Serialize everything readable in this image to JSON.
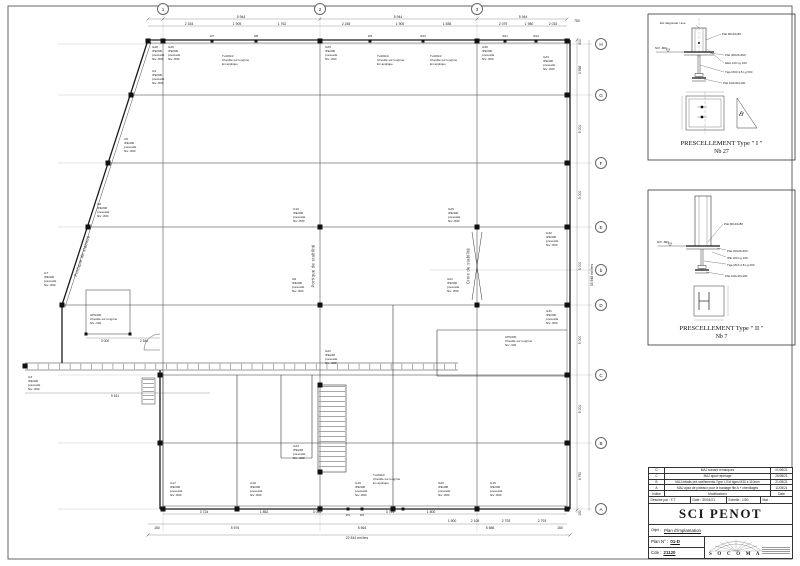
{
  "plan": {
    "bubbles": [
      {
        "t": "1",
        "x": 163,
        "y": 9
      },
      {
        "t": "2",
        "x": 320,
        "y": 9
      },
      {
        "t": "3",
        "x": 477,
        "y": 9
      },
      {
        "t": "H",
        "x": 601,
        "y": 44
      },
      {
        "t": "G",
        "x": 601,
        "y": 95
      },
      {
        "t": "F",
        "x": 601,
        "y": 163
      },
      {
        "t": "E",
        "x": 601,
        "y": 227
      },
      {
        "t": "b",
        "x": 601,
        "y": 270
      },
      {
        "t": "D",
        "x": 601,
        "y": 305
      },
      {
        "t": "C",
        "x": 601,
        "y": 375
      },
      {
        "t": "B",
        "x": 601,
        "y": 443
      },
      {
        "t": "A",
        "x": 601,
        "y": 509
      }
    ],
    "dims": [
      {
        "x": 241,
        "y": 17,
        "t": "5 944"
      },
      {
        "x": 398,
        "y": 17,
        "t": "5 944"
      },
      {
        "x": 523,
        "y": 17,
        "t": "5 944"
      },
      {
        "x": 189,
        "y": 24,
        "t": "2 334"
      },
      {
        "x": 237,
        "y": 24,
        "t": "1 905"
      },
      {
        "x": 282,
        "y": 24,
        "t": "1 762"
      },
      {
        "x": 346,
        "y": 24,
        "t": "2 248"
      },
      {
        "x": 400,
        "y": 24,
        "t": "1 905"
      },
      {
        "x": 447,
        "y": 24,
        "t": "1 836"
      },
      {
        "x": 503,
        "y": 24,
        "t": "2 079"
      },
      {
        "x": 529,
        "y": 24,
        "t": "1 980"
      },
      {
        "x": 553,
        "y": 24,
        "t": "2 015"
      },
      {
        "x": 577,
        "y": 21,
        "t": "750"
      },
      {
        "x": 580,
        "y": 42,
        "t": "500",
        "rot": -90
      },
      {
        "x": 580,
        "y": 70,
        "t": "3 598",
        "rot": -90
      },
      {
        "x": 580,
        "y": 129,
        "t": "5 000",
        "rot": -90
      },
      {
        "x": 580,
        "y": 195,
        "t": "5 000",
        "rot": -90
      },
      {
        "x": 580,
        "y": 266,
        "t": "5 000",
        "rot": -90
      },
      {
        "x": 580,
        "y": 340,
        "t": "5 000",
        "rot": -90
      },
      {
        "x": 580,
        "y": 409,
        "t": "5 000",
        "rot": -90
      },
      {
        "x": 580,
        "y": 476,
        "t": "4 750",
        "rot": -90
      },
      {
        "x": 580,
        "y": 513,
        "t": "150",
        "rot": -90
      },
      {
        "x": 591.5,
        "y": 275,
        "t": "33 948 ext fers",
        "rot": -90
      },
      {
        "x": 204,
        "y": 512,
        "t": "3 724"
      },
      {
        "x": 264,
        "y": 512,
        "t": "1 852"
      },
      {
        "x": 317,
        "y": 512,
        "t": "3 046"
      },
      {
        "x": 390,
        "y": 512,
        "t": "3 724"
      },
      {
        "x": 431,
        "y": 512,
        "t": "1 800"
      },
      {
        "x": 452,
        "y": 521,
        "t": "1 500"
      },
      {
        "x": 475,
        "y": 521,
        "t": "2 108"
      },
      {
        "x": 506,
        "y": 521,
        "t": "2 793"
      },
      {
        "x": 542,
        "y": 521,
        "t": "2 793"
      },
      {
        "x": 157,
        "y": 528,
        "t": "150"
      },
      {
        "x": 235,
        "y": 528,
        "t": "5 576"
      },
      {
        "x": 362,
        "y": 528,
        "t": "5 564"
      },
      {
        "x": 490,
        "y": 528,
        "t": "5 586"
      },
      {
        "x": 560,
        "y": 528,
        "t": "150"
      },
      {
        "x": 357,
        "y": 538,
        "t": "22 544 ext fers"
      },
      {
        "x": 115,
        "y": 396,
        "t": "9 611"
      },
      {
        "x": 105,
        "y": 341,
        "t": "3 000"
      },
      {
        "x": 144,
        "y": 341,
        "t": "2 540"
      }
    ],
    "col_labels": [
      {
        "x": 152,
        "y": 46,
        "t": "G28\nIPE300\nprescellé\nNiv -800"
      },
      {
        "x": 168,
        "y": 46,
        "t": "G26\nIPE300\nprescellé\nNiv -800"
      },
      {
        "x": 325,
        "y": 46,
        "t": "G25\nIPE300\nprescellé\nNiv -800"
      },
      {
        "x": 482,
        "y": 46,
        "t": "G30\nIPE300\nprescellé\nNiv -800"
      },
      {
        "x": 543,
        "y": 56,
        "t": "G34\nIPE300\nprescellé\nNiv -800"
      },
      {
        "x": 152,
        "y": 70,
        "t": "G4\nIPE300\nprescellé\nNiv -800"
      },
      {
        "x": 124,
        "y": 138,
        "t": "G5\nIPE300\nprescellé\nNiv -800"
      },
      {
        "x": 97,
        "y": 203,
        "t": "G6\nIPE300\nprescellé\nNiv -800"
      },
      {
        "x": 44,
        "y": 272,
        "t": "G7\nIPE300\nprescellé\nNiv -800"
      },
      {
        "x": 293,
        "y": 208,
        "t": "G10\nIPE300\nprescellé\nNiv -800"
      },
      {
        "x": 292,
        "y": 278,
        "t": "G8\nIPE300\nprescellé\nNiv -800"
      },
      {
        "x": 448,
        "y": 208,
        "t": "G29\nIPE300\nprescellé\nNiv -800"
      },
      {
        "x": 447,
        "y": 278,
        "t": "G21\nIPE300\nprescellé\nNiv -800"
      },
      {
        "x": 546,
        "y": 232,
        "t": "G32\nIPE300\nprescellé\nNiv -800"
      },
      {
        "x": 546,
        "y": 310,
        "t": "G31\nIPE300\nprescellé\nNiv -800"
      },
      {
        "x": 28,
        "y": 376,
        "t": "G3\nIPE300\nprescellé\nNiv -800"
      },
      {
        "x": 170,
        "y": 482,
        "t": "G17\nIPE300\nprescellé\nNiv -800"
      },
      {
        "x": 250,
        "y": 482,
        "t": "G18\nIPE300\nprescellé\nNiv -800"
      },
      {
        "x": 355,
        "y": 482,
        "t": "G19\nIPE300\nprescellé\nNiv -800"
      },
      {
        "x": 438,
        "y": 482,
        "t": "G20\nIPE300\nprescellé\nNiv -800"
      },
      {
        "x": 490,
        "y": 482,
        "t": "G15\nIPE300\nprescellé\nNiv -800"
      },
      {
        "x": 325,
        "y": 350,
        "t": "G22\nIPE240\nprescellé\nNiv -320"
      },
      {
        "x": 293,
        "y": 445,
        "t": "G23\nIPE240\nprescellé\nNiv -320"
      }
    ],
    "notes": [
      {
        "x": 313,
        "y": 266,
        "t": "Portique de stabilité",
        "rot": -90
      },
      {
        "x": 468,
        "y": 266,
        "t": "Croix de stabilité",
        "rot": -90
      },
      {
        "x": 82,
        "y": 256,
        "t": "Portique de stabilité",
        "rot": -72
      }
    ],
    "annotations": [
      {
        "x": 222,
        "y": 55,
        "t": "Tu100x3\nCheville sur longrine\nEn applique"
      },
      {
        "x": 377,
        "y": 55,
        "t": "Tu100x3\nCheville sur longrine\nEn applique"
      },
      {
        "x": 430,
        "y": 55,
        "t": "Tu100x3\nCheville sur longrine\nEn applique"
      },
      {
        "x": 373,
        "y": 474,
        "t": "Tu100x3\nCheville sur longrine\nEn applique"
      },
      {
        "x": 90,
        "y": 314,
        "t": "UPN200\nCheville sur longrine\nNiv -320"
      },
      {
        "x": 505,
        "y": 336,
        "t": "UPN200\nCheville sur longrine\nNiv -320"
      }
    ],
    "post_labels": [
      {
        "x": 212,
        "y": 36,
        "t": "W7"
      },
      {
        "x": 256,
        "y": 36,
        "t": "W8"
      },
      {
        "x": 370,
        "y": 36,
        "t": "W9"
      },
      {
        "x": 423,
        "y": 36,
        "t": "W10"
      },
      {
        "x": 505,
        "y": 36,
        "t": "W11"
      },
      {
        "x": 536,
        "y": 36,
        "t": "W12"
      },
      {
        "x": 348,
        "y": 515,
        "t": "W1"
      },
      {
        "x": 362,
        "y": 515,
        "t": "W2"
      }
    ]
  },
  "detail_labels": [
    {
      "x": 722,
      "y": 32,
      "t": "Plat 80x10x80"
    },
    {
      "x": 725,
      "y": 53,
      "t": "Plat 300x5x300"
    },
    {
      "x": 725,
      "y": 61,
      "t": "HEA 140 Lg 100"
    },
    {
      "x": 725,
      "y": 70,
      "t": "Tige M30 4.8 Lg 500"
    },
    {
      "x": 723,
      "y": 81,
      "t": "Plat 100x20x100"
    },
    {
      "x": 660,
      "y": 21,
      "t": "Ext diagonale / axe"
    },
    {
      "x": 655,
      "y": 46,
      "t": "NIV -800"
    },
    {
      "x": 724,
      "y": 222,
      "t": "Plat 80x10x80"
    },
    {
      "x": 727,
      "y": 249,
      "t": "Plat 200x5x200"
    },
    {
      "x": 727,
      "y": 256,
      "t": "IPE 100 Lg 100"
    },
    {
      "x": 727,
      "y": 263,
      "t": "Tige M16 4.8 Lg 300"
    },
    {
      "x": 725,
      "y": 274,
      "t": "Plat 100x15x100"
    },
    {
      "x": 657,
      "y": 240,
      "t": "NIV -800"
    }
  ],
  "details": [
    {
      "title": "PRESCELLEMENT Type \" I \"",
      "nb": "Nb 27",
      "triangle_letter": "B"
    },
    {
      "title": "PRESCELLEMENT Type \" II \"",
      "nb": "Nb 7"
    }
  ],
  "titleblock": {
    "revisions": [
      {
        "i": "D",
        "m": "MAJ suivant remarques",
        "d": "01/06/21"
      },
      {
        "i": "C",
        "m": "MAJ ajout repérage",
        "d": "26/05/21"
      },
      {
        "i": "B",
        "m": "MAJ détails pré-scellements Type I, Ext tiges M30 à 110mm",
        "d": "21/05/21"
      },
      {
        "i": "A",
        "m": "MAJ ajout de poteaux pour le bardage file A + chevillages",
        "d": "11/05/21"
      }
    ],
    "header": {
      "indice": "Indice",
      "modifications": "Modifications",
      "date": "Date"
    },
    "info": {
      "drawn": "Dessiné par : F.T",
      "date": "Date : 30/04/21",
      "scale": "Echelle : 1/50",
      "mat": "Mat : ."
    },
    "title": "SCI PENOT",
    "objet_label": "Objet :",
    "objet": "Plan d'implantation",
    "plan_label": "Plan N° :",
    "plan_no": "01-D",
    "cde_label": "Cde :",
    "cde": "21120",
    "logo": "S O C O M A"
  }
}
